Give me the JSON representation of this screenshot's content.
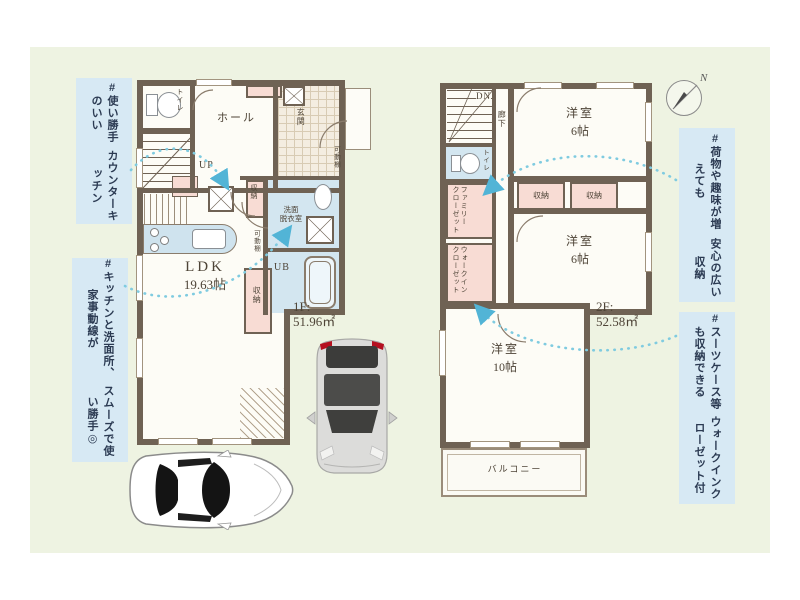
{
  "annotations": {
    "counterKitchen": {
      "l1": "#使い勝手のいい",
      "l2": "カウンターキッチン"
    },
    "flow": {
      "l1": "#キッチンと洗面所、家事動線が",
      "l2": "スムーズで使い勝手◎"
    },
    "storage": {
      "l1": "#荷物や趣味が増えても",
      "l2": "安心の広い収納"
    },
    "wic": {
      "l1": "#スーツケース等も収納できる",
      "l2": "ウォークインクローゼット付"
    }
  },
  "f1": {
    "toilet": "トイレ",
    "hall": "ホール",
    "up": "UP",
    "entrance": "玄関",
    "shelf1": "可動棚",
    "shelf2": "可動棚",
    "storageMid": "収納",
    "washroom1": "洗面",
    "washroom2": "脱衣室",
    "ub": "UB",
    "ldk": "LDK",
    "ldkSize": "19.63帖",
    "storageLdk": "収納",
    "floor": "1F:",
    "area": "51.96㎡"
  },
  "f2": {
    "dn": "DN",
    "corridor": "廊下",
    "toilet": "トイレ",
    "familyCloset1": "ファミリー",
    "familyCloset2": "クローゼット",
    "wic1": "ウォークイン",
    "wic2": "クローゼット",
    "room1": "洋室",
    "room1Size": "6帖",
    "storage1": "収納",
    "storage2": "収納",
    "room2": "洋室",
    "room2Size": "6帖",
    "room3": "洋室",
    "room3Size": "10帖",
    "balcony": "バルコニー",
    "floor": "2F:",
    "area": "52.58㎡"
  },
  "compass": {
    "n": "N"
  },
  "colors": {
    "panel": "#eef3e2",
    "wall": "#6f6254",
    "roomPink": "#f8dcd4",
    "roomBlue": "#d3e6f0",
    "annotBg": "#d7e9f4",
    "annotText": "#2b3a52",
    "arrow": "#7fcbe0",
    "labelText": "#4e4437"
  }
}
